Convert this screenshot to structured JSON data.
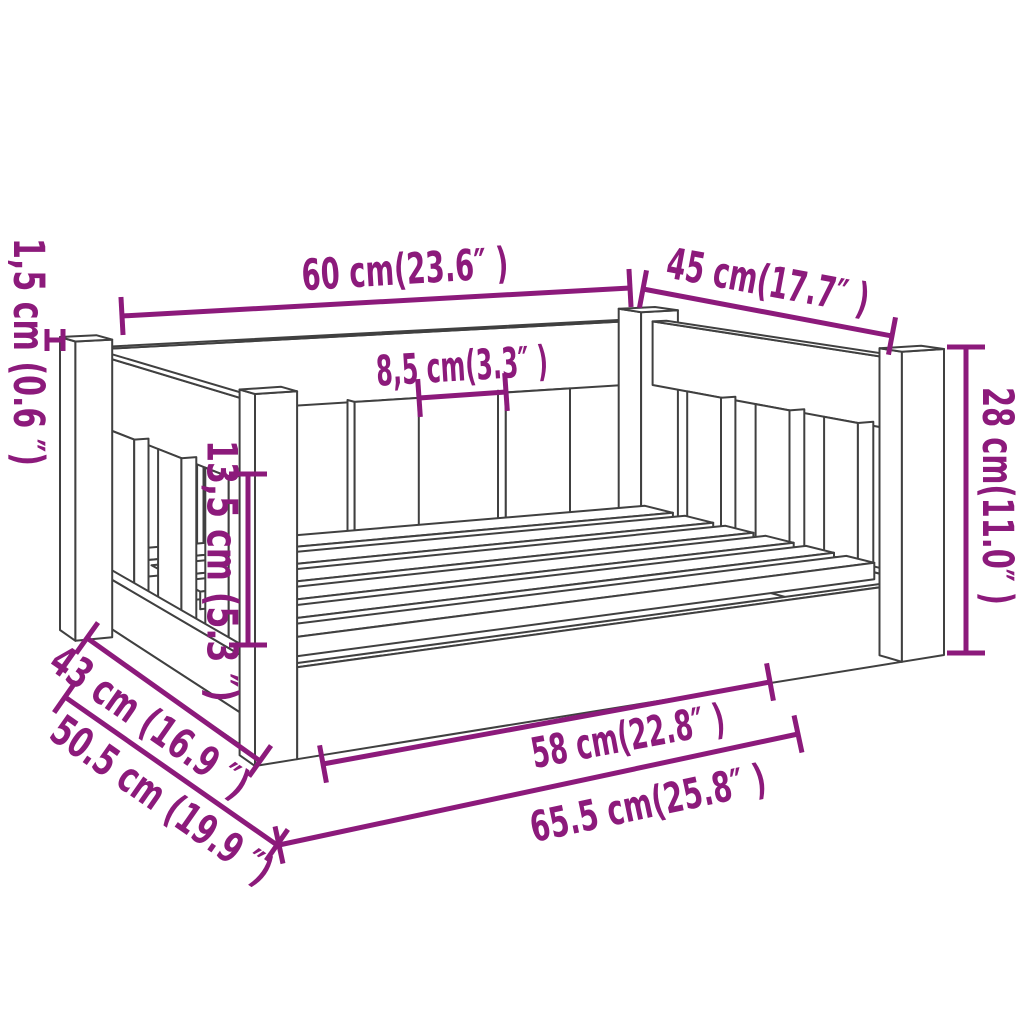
{
  "title": "Dog bed dimension diagram",
  "colors": {
    "dimension": "#8C1A7B",
    "outline": "#404040",
    "background": "#FFFFFF"
  },
  "dimensions": {
    "back_length": {
      "label": "60 cm(23.6″ )"
    },
    "side_depth": {
      "label": "45 cm(17.7″ )"
    },
    "board_thickness": {
      "label": "1,5 cm (0.6 ″)"
    },
    "slat_gap": {
      "label": "8,5 cm(3.3″ )"
    },
    "opening_height": {
      "label": "13,5 cm (5.3 ″)"
    },
    "post_height": {
      "label": "28 cm(11.0″ )"
    },
    "inner_depth": {
      "label": "43 cm (16.9 ″)"
    },
    "outer_depth": {
      "label": "50.5 cm (19.9 ″)"
    },
    "inner_length": {
      "label": "58 cm(22.8″ )"
    },
    "outer_length": {
      "label": "65.5 cm(25.8″ )"
    }
  }
}
